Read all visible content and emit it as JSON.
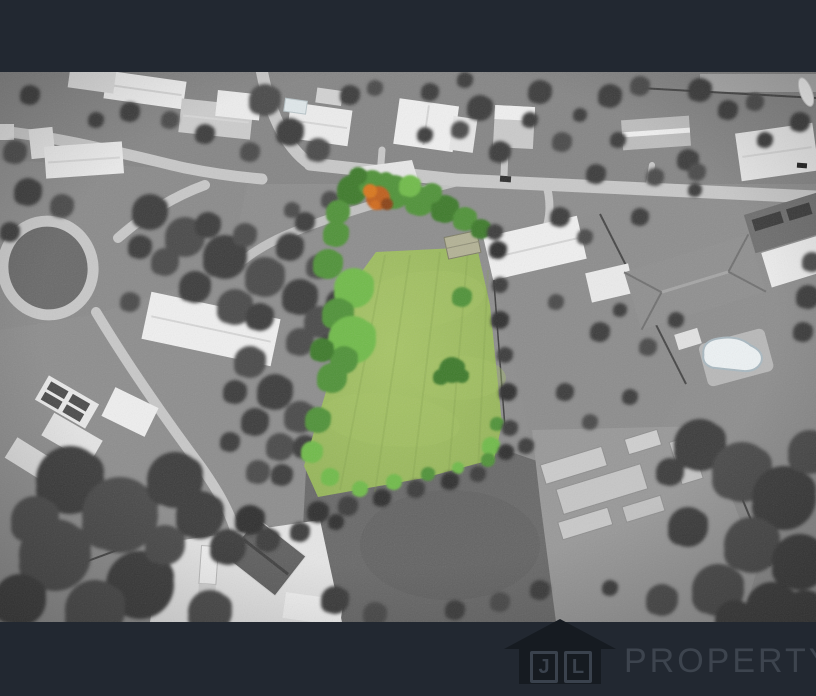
{
  "branding": {
    "initials": [
      "J",
      "L"
    ],
    "name": "PROPERTY"
  },
  "features": [
    "highlighted-land-parcel",
    "suburban-houses",
    "streets",
    "cul-de-sac",
    "trees",
    "swimming-pool",
    "garden-beds",
    "shed",
    "truck"
  ],
  "colors": {
    "letterbox": "#222831",
    "logo_house": "#161b21",
    "logo_letter": "#3a424d",
    "logo_text": "#3d444e",
    "photo_base": "#8d8d8d",
    "road": "#c8c8c8",
    "roof_white": "#f0f0f0",
    "paddock": "#686868",
    "garden": "#989898",
    "tree_dark": "#2d2d2d",
    "tree_mid": "#3b3b3b",
    "tree_soft": "#4a4a4a",
    "grass": "#93b357",
    "grass_light": "#a7c566",
    "green_dark": "#3c7a2b",
    "green_mid": "#4f9237",
    "green_bright": "#6fbb48",
    "orange": "#bf5f1e",
    "pool": "#edf2f4"
  }
}
